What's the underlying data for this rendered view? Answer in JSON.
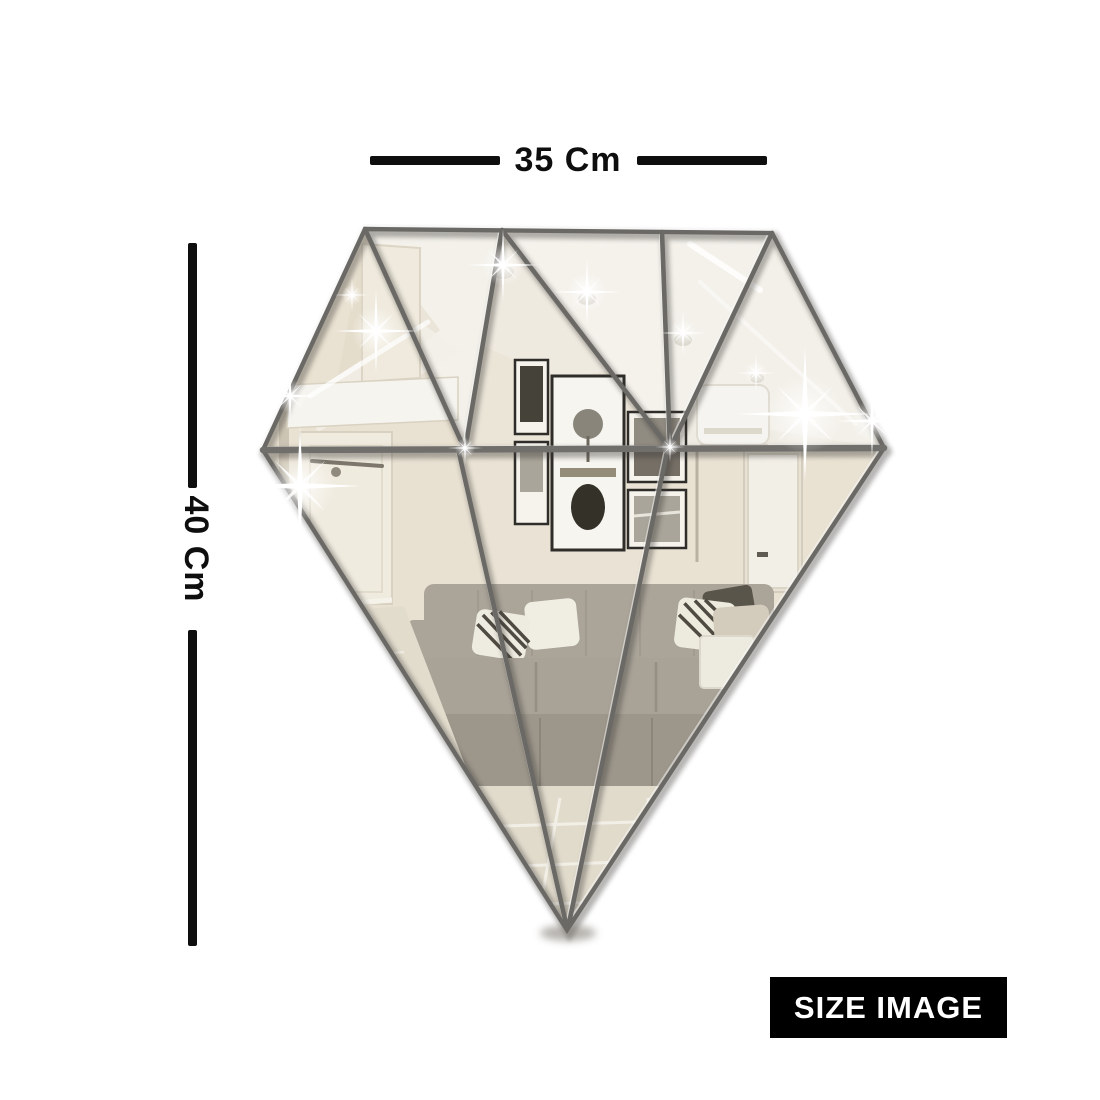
{
  "annotations": {
    "width_label": "35 Cm",
    "height_label": "40 Cm"
  },
  "badge": {
    "label": "SIZE IMAGE",
    "background": "#000000",
    "text_color": "#ffffff"
  },
  "graphic": {
    "subject": "diamond-shaped faceted mirror wall sticker reflecting a living room",
    "facet_count": 9,
    "colors": {
      "dimension_lines": "#0e0e0e",
      "mirror_tint_light": "#f2efe8",
      "mirror_tint_warm": "#e9e2d3",
      "facet_gap_line": "#6b6965",
      "sofa_grey": "#aaa499",
      "picture_frame": "#2f2d29",
      "sparkle": "#ffffff",
      "floor": "#e1dbcc"
    }
  }
}
